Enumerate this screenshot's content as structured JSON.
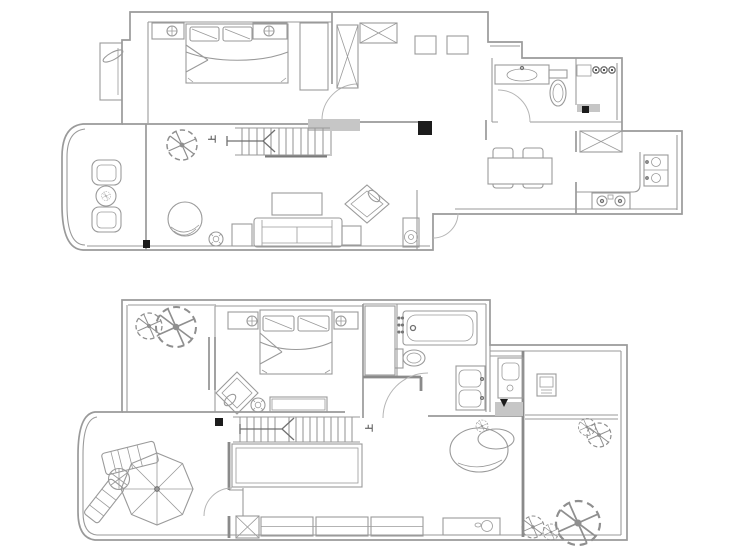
{
  "page": {
    "background": "#ffffff"
  },
  "colors": {
    "line": "#9a9a9a",
    "line_dark": "#707070",
    "wall_fill": "#c6c6c6",
    "hatch_dark": "#8a8a8a",
    "black": "#1c1c1c",
    "arc": "#b5b5b5",
    "label": "#4a4a4a"
  },
  "plans": [
    {
      "name": "upper-floor-plan",
      "stairs_label": "上",
      "symbols": [
        "double-bed",
        "pillow",
        "nightstand",
        "table-lamp",
        "wardrobe-hatch",
        "linen-cabinet-x",
        "shoe-cabinet-x",
        "hall-cabinet",
        "stairs-up",
        "direction-arrow",
        "column",
        "landing",
        "sofa",
        "coffee-table",
        "side-table",
        "accent-chair",
        "swivel-chair",
        "plant",
        "speaker",
        "armchair",
        "round-table",
        "balcony-decor",
        "vanity-sink",
        "toilet",
        "shower-heads",
        "shower-bench",
        "refrigerator-x",
        "kitchen-counter",
        "double-sink",
        "stove",
        "dining-table",
        "dining-chair",
        "door-arc",
        "bay-window"
      ]
    },
    {
      "name": "lower-floor-plan",
      "stairs_label": "上",
      "symbols": [
        "double-bed",
        "pillow",
        "nightstand",
        "table-lamp",
        "closet-hatch",
        "bathtub",
        "toilet",
        "double-vanity",
        "washing-machine",
        "control-box",
        "stairs-up",
        "direction-arrow",
        "platform",
        "planter-box",
        "planter-x",
        "parasol",
        "lounge-chair",
        "round-table",
        "round-daybed",
        "bench",
        "tree",
        "flower",
        "accent-chair",
        "speaker",
        "door-arc",
        "bay-window"
      ]
    }
  ]
}
